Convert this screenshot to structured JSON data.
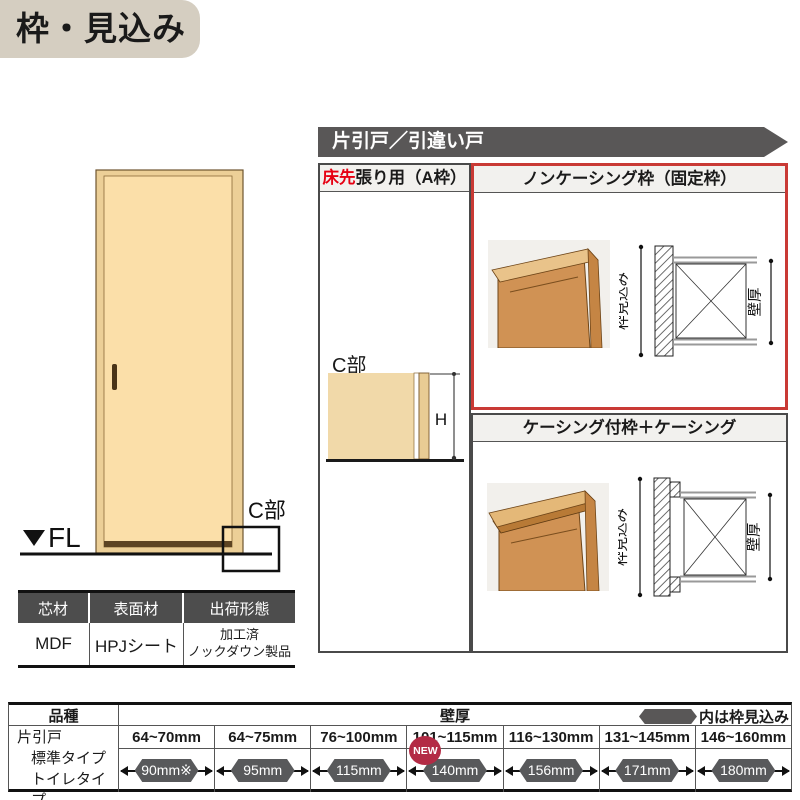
{
  "title": "枠・見込み",
  "banner": "片引戸／引違い戸",
  "door_figure": {
    "fl": "FL",
    "c_label": "C部"
  },
  "spec_table": {
    "headers": [
      "芯材",
      "表面材",
      "出荷形態"
    ],
    "core": "MDF",
    "surface": "HPJシート",
    "shipping_line1": "加工済",
    "shipping_line2": "ノックダウン製品"
  },
  "column_a": {
    "header_em": "床先",
    "header_rest": "張り用（A枠）",
    "c_label": "C部",
    "h_label": "H"
  },
  "noncasing": {
    "header": "ノンケーシング枠（固定枠）",
    "frame_depth_label": "枠見込み",
    "wall_label": "壁厚"
  },
  "casing": {
    "header": "ケーシング付枠＋ケーシング",
    "frame_depth_label": "枠見込み",
    "wall_label": "壁厚"
  },
  "bottom_table": {
    "kind": "品種",
    "wall": "壁厚",
    "legend": "内は枠見込み",
    "row_lines": [
      "片引戸",
      "標準タイプ",
      "トイレタイプ"
    ],
    "new_label": "NEW",
    "columns": [
      {
        "range": "64~70mm",
        "value": "90mm※"
      },
      {
        "range": "64~75mm",
        "value": "95mm"
      },
      {
        "range": "76~100mm",
        "value": "115mm"
      },
      {
        "range": "101~115mm",
        "value": "140mm"
      },
      {
        "range": "116~130mm",
        "value": "156mm"
      },
      {
        "range": "131~145mm",
        "value": "171mm"
      },
      {
        "range": "146~160mm",
        "value": "180mm"
      }
    ]
  },
  "colors": {
    "accent_red": "#c93a35",
    "banner_gray": "#595757",
    "badge_gray": "#58595b",
    "new_red": "#b32b45",
    "title_bg": "#d5cec1",
    "door_tan": "#fbdfa9"
  }
}
